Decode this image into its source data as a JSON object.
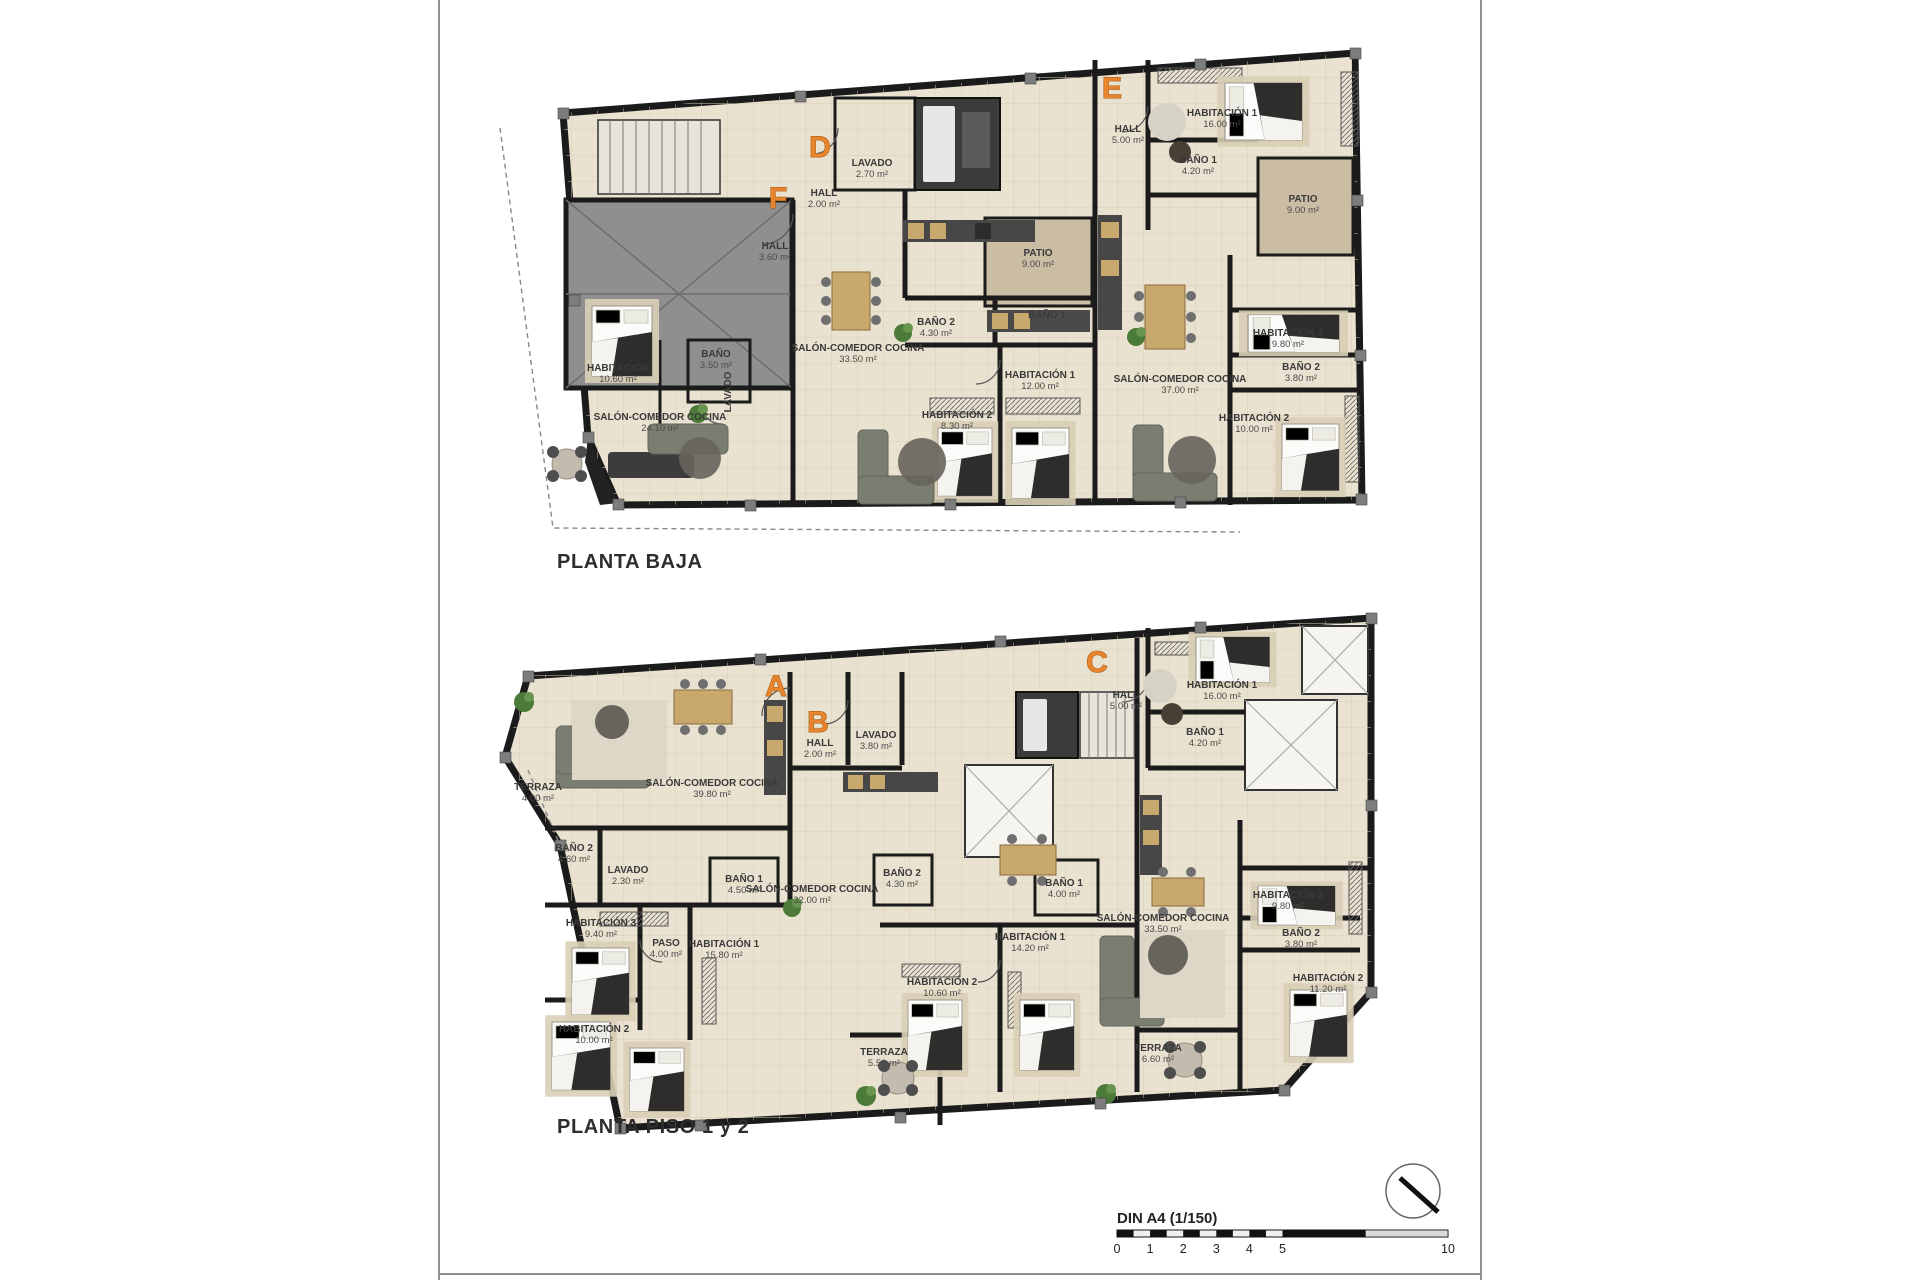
{
  "palette": {
    "wall": "#1b1b1b",
    "floor": "#eae2d0",
    "patio": "#cbbda4",
    "garage": "#8f8f8f",
    "unit_letter_accent": "#e8842d",
    "label_text": "#3a3a3a",
    "sofa": "#7a7e71",
    "wood": "#c9a86e",
    "plant": "#4c7a38"
  },
  "plans": [
    {
      "title": "PLANTA BAJA",
      "units": [
        {
          "letter": "F",
          "x": 778,
          "y": 208
        },
        {
          "letter": "D",
          "x": 820,
          "y": 157
        },
        {
          "letter": "E",
          "x": 1112,
          "y": 98
        }
      ],
      "rooms": [
        {
          "name": "HALL",
          "area": "3.60 m²",
          "x": 775,
          "y": 249
        },
        {
          "name": "HABITACIÓN",
          "area": "10.60 m²",
          "x": 618,
          "y": 371
        },
        {
          "name": "BAÑO",
          "area": "3.50 m²",
          "x": 716,
          "y": 357
        },
        {
          "name": "LAVADO",
          "area": "",
          "x": 731,
          "y": 392,
          "rot": -90
        },
        {
          "name": "SALÓN-COMEDOR COCINA",
          "area": "24.10 m²",
          "x": 660,
          "y": 420
        },
        {
          "name": "LAVADO",
          "area": "2.70 m²",
          "x": 872,
          "y": 166
        },
        {
          "name": "HALL",
          "area": "2.00 m²",
          "x": 824,
          "y": 196
        },
        {
          "name": "SALÓN-COMEDOR COCINA",
          "area": "33.50 m²",
          "x": 858,
          "y": 351
        },
        {
          "name": "BAÑO 2",
          "area": "4.30 m²",
          "x": 936,
          "y": 325
        },
        {
          "name": "BAÑO 1",
          "area": "4.00 m²",
          "x": 1047,
          "y": 318
        },
        {
          "name": "HABITACIÓN 1",
          "area": "12.00 m²",
          "x": 1040,
          "y": 378
        },
        {
          "name": "HABITACIÓN 2",
          "area": "8.30 m²",
          "x": 957,
          "y": 418
        },
        {
          "name": "PATIO",
          "area": "9.00 m²",
          "x": 1038,
          "y": 256
        },
        {
          "name": "HALL",
          "area": "5.00 m²",
          "x": 1128,
          "y": 132
        },
        {
          "name": "HABITACIÓN 1",
          "area": "16.00 m²",
          "x": 1222,
          "y": 116
        },
        {
          "name": "BAÑO 1",
          "area": "4.20 m²",
          "x": 1198,
          "y": 163
        },
        {
          "name": "PATIO",
          "area": "9.00 m²",
          "x": 1303,
          "y": 202
        },
        {
          "name": "SALÓN-COMEDOR COCINA",
          "area": "37.00 m²",
          "x": 1180,
          "y": 382
        },
        {
          "name": "HABITACIÓN 3",
          "area": "9.80 m²",
          "x": 1288,
          "y": 336
        },
        {
          "name": "BAÑO 2",
          "area": "3.80 m²",
          "x": 1301,
          "y": 370
        },
        {
          "name": "HABITACIÓN 2",
          "area": "10.00 m²",
          "x": 1254,
          "y": 421
        }
      ]
    },
    {
      "title": "PLANTA PISO 1 y 2",
      "units": [
        {
          "letter": "A",
          "x": 776,
          "y": 696
        },
        {
          "letter": "B",
          "x": 818,
          "y": 732
        },
        {
          "letter": "C",
          "x": 1097,
          "y": 672
        }
      ],
      "rooms": [
        {
          "name": "TERRAZA",
          "area": "4.00 m²",
          "x": 538,
          "y": 790
        },
        {
          "name": "SALÓN-COMEDOR COCINA",
          "area": "39.80 m²",
          "x": 712,
          "y": 786
        },
        {
          "name": "BAÑO 2",
          "area": "4.60 m²",
          "x": 574,
          "y": 851
        },
        {
          "name": "LAVADO",
          "area": "2.30 m²",
          "x": 628,
          "y": 873
        },
        {
          "name": "HABITACIÓN 3",
          "area": "9.40 m²",
          "x": 601,
          "y": 926
        },
        {
          "name": "PASO",
          "area": "4.00 m²",
          "x": 666,
          "y": 946
        },
        {
          "name": "HABITACIÓN 1",
          "area": "15.80 m²",
          "x": 724,
          "y": 947
        },
        {
          "name": "BAÑO 1",
          "area": "4.50 m²",
          "x": 744,
          "y": 882
        },
        {
          "name": "HABITACIÓN 2",
          "area": "10.00 m²",
          "x": 594,
          "y": 1032
        },
        {
          "name": "HALL",
          "area": "2.00 m²",
          "x": 820,
          "y": 746
        },
        {
          "name": "LAVADO",
          "area": "3.80 m²",
          "x": 876,
          "y": 738
        },
        {
          "name": "SALÓN-COMEDOR COCINA",
          "area": "32.00 m²",
          "x": 812,
          "y": 892
        },
        {
          "name": "BAÑO 2",
          "area": "4.30 m²",
          "x": 902,
          "y": 876
        },
        {
          "name": "BAÑO 1",
          "area": "4.00 m²",
          "x": 1064,
          "y": 886
        },
        {
          "name": "HABITACIÓN 1",
          "area": "14.20 m²",
          "x": 1030,
          "y": 940
        },
        {
          "name": "HABITACIÓN 2",
          "area": "10.60 m²",
          "x": 942,
          "y": 985
        },
        {
          "name": "TERRAZA",
          "area": "5.50 m²",
          "x": 884,
          "y": 1055
        },
        {
          "name": "HALL",
          "area": "5.00 m²",
          "x": 1126,
          "y": 698
        },
        {
          "name": "HABITACIÓN 1",
          "area": "16.00 m²",
          "x": 1222,
          "y": 688
        },
        {
          "name": "BAÑO 1",
          "area": "4.20 m²",
          "x": 1205,
          "y": 735
        },
        {
          "name": "SALÓN-COMEDOR COCINA",
          "area": "33.50 m²",
          "x": 1163,
          "y": 921
        },
        {
          "name": "HABITACIÓN 3",
          "area": "9.80 m²",
          "x": 1288,
          "y": 898
        },
        {
          "name": "BAÑO 2",
          "area": "3.80 m²",
          "x": 1301,
          "y": 936
        },
        {
          "name": "HABITACIÓN 2",
          "area": "11.20 m²",
          "x": 1328,
          "y": 981
        },
        {
          "name": "TERRAZA",
          "area": "6.60 m²",
          "x": 1158,
          "y": 1051
        }
      ]
    }
  ],
  "footer": {
    "scale_label": "DIN A4 (1/150)",
    "scale_ticks": [
      "0",
      "1",
      "2",
      "3",
      "4",
      "5",
      "10"
    ]
  }
}
